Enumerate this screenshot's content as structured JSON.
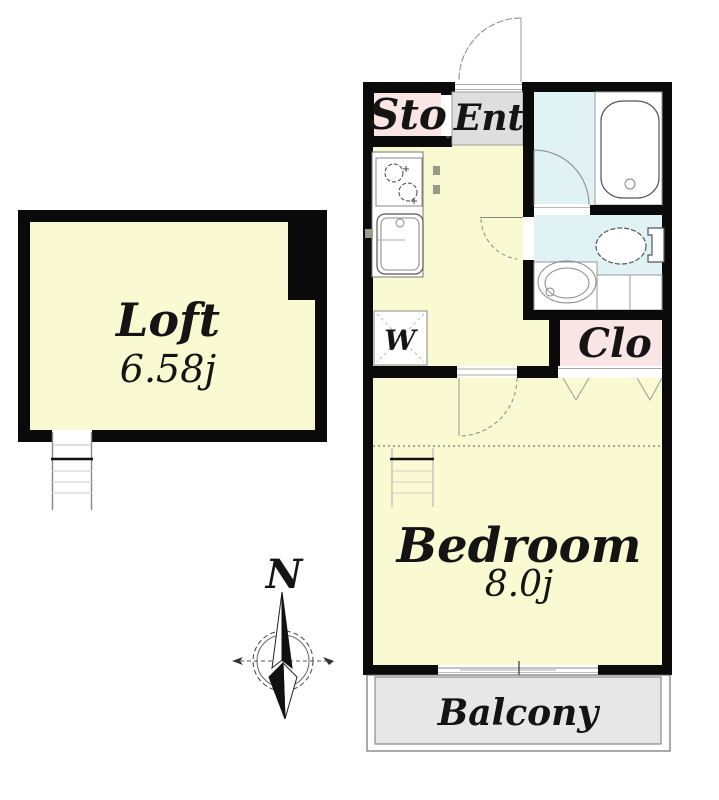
{
  "colors": {
    "wall_black": "#0a0a0a",
    "floor_yellow": "#FAFAD2",
    "room_pink": "#FAE5E5",
    "entrance_gray": "#DEDEDE",
    "bath_cyan": "#E1F2F5",
    "balcony_gray": "#E7E7E7"
  },
  "rooms": {
    "loft": {
      "name": "Loft",
      "area": "6.58j"
    },
    "storage": {
      "name": "Sto"
    },
    "entrance": {
      "name": "Ent"
    },
    "closet": {
      "name": "Clo"
    },
    "washer": {
      "name": "W"
    },
    "bedroom": {
      "name": "Bedroom",
      "area": "8.0j"
    },
    "balcony": {
      "name": "Balcony"
    }
  },
  "compass": {
    "north_label": "N"
  }
}
